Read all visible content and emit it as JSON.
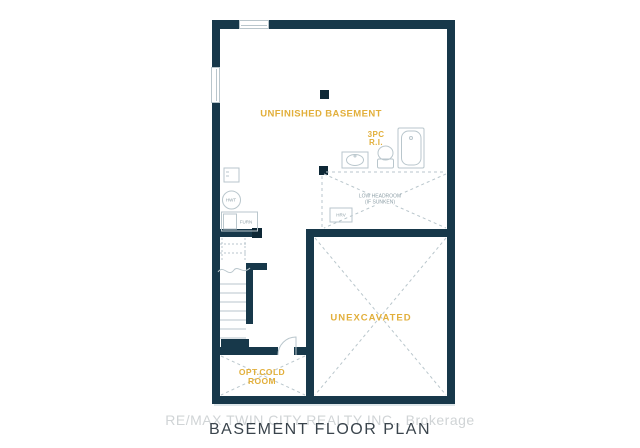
{
  "page": {
    "title": "BASEMENT FLOOR PLAN",
    "watermark": "RE/MAX TWIN CITY REALTY INC., Brokerage"
  },
  "rooms": {
    "unfinished_basement": {
      "label": "UNFINISHED BASEMENT"
    },
    "bath": {
      "line1": "3PC",
      "line2": "R.I."
    },
    "unexcavated": {
      "label": "UNEXCAVATED"
    },
    "cold_room": {
      "line1": "OPT.COLD",
      "line2": "ROOM"
    },
    "low_headroom": {
      "line1": "LOW HEADROOM",
      "line2": "(IF SUNKEN)"
    }
  },
  "equipment": {
    "hwt": "HWT",
    "furnace": "FURN",
    "hrv": "HRV"
  },
  "colors": {
    "wall": "#17384a",
    "pillar": "#0e2836",
    "accent": "#e2af3b",
    "linework": "#b9c6cc",
    "watermark": "#d0d4d6",
    "title": "#3a444c"
  }
}
